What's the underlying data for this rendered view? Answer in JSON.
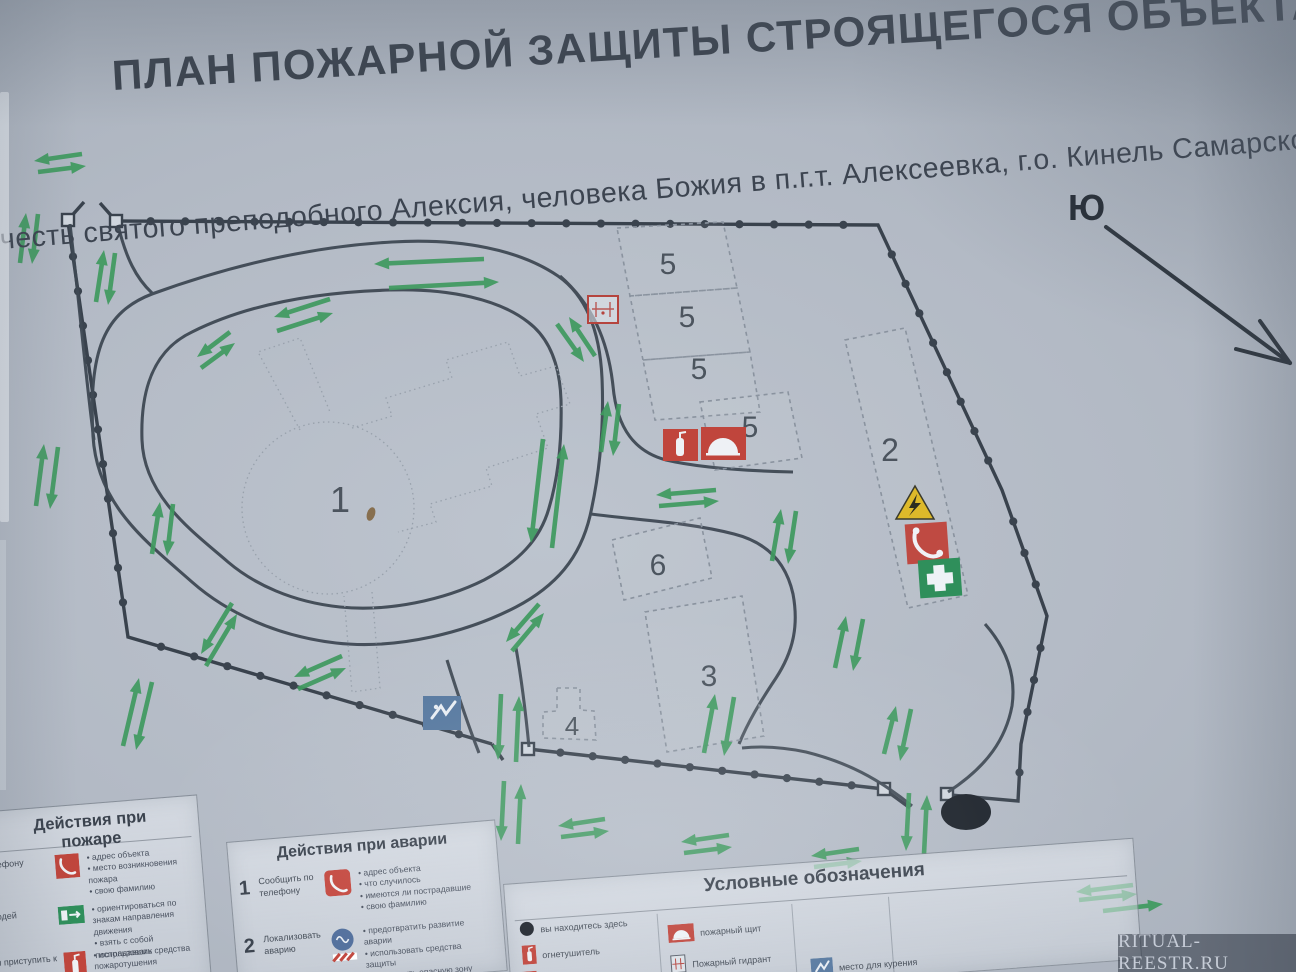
{
  "title": "ПЛАН ПОЖАРНОЙ ЗАЩИТЫ СТРОЯЩЕГОСЯ ОБЪЕКТА",
  "subtitle": "честь святого преподобного Алексия, человека Божия  в п.г.т. Алексеевка, г.о. Кинель Самарской о",
  "compass": {
    "label": "Ю"
  },
  "plan": {
    "buildings": [
      {
        "label": "1"
      },
      {
        "label": "2"
      },
      {
        "label": "3"
      },
      {
        "label": "4"
      },
      {
        "label": "5"
      },
      {
        "label": "5"
      },
      {
        "label": "5"
      },
      {
        "label": "5"
      },
      {
        "label": "6"
      }
    ],
    "icons": [
      "fire-hydrant",
      "fire-extinguisher",
      "fire-shield",
      "electrical-hazard",
      "emergency-phone",
      "first-aid",
      "smoking-area",
      "you-are-here"
    ]
  },
  "legend_fire": {
    "title": "Действия при пожаре",
    "rows": [
      {
        "label": "Сообщить по телефону",
        "bullets": [
          "адрес объекта",
          "место возникновения пожара",
          "свою фамилию"
        ]
      },
      {
        "label": "Эвакуировать людей",
        "bullets": [
          "ориентироваться по знакам направления движения",
          "взять с собой пострадавших"
        ]
      },
      {
        "label": "По возможности приступить к тушению",
        "bullets": [
          "использовать средства пожаротушения"
        ]
      }
    ]
  },
  "legend_accident": {
    "title": "Действия при аварии",
    "rows": [
      {
        "num": "1",
        "label": "Сообщить по телефону",
        "bullets": [
          "адрес объекта",
          "что случилось",
          "имеются ли пострадавшие",
          "свою фамилию"
        ]
      },
      {
        "num": "2",
        "label": "Локализовать аварию",
        "bullets": [
          "предотвратить развитие аварии",
          "использовать средства защиты",
          "обозначить опасную зону"
        ]
      }
    ]
  },
  "legend_symbols": {
    "title": "Условные обозначения",
    "items": [
      {
        "icon": "you-are-here-dot",
        "label": "вы находитесь здесь"
      },
      {
        "icon": "fire-extinguisher",
        "label": "огнетушитель"
      },
      {
        "icon": "fire-shield",
        "label": "пожарный щит"
      },
      {
        "icon": "fire-hydrant",
        "label": "Пожарный гидрант"
      },
      {
        "icon": "smoking-area",
        "label": "место для курения"
      }
    ]
  },
  "watermark": "RITUAL-REESTR.RU",
  "colors": {
    "arrow_green": "#3f9a5f",
    "line_dark": "#3a434e",
    "danger_red": "#c0453c",
    "safe_green": "#2f8f5b",
    "info_blue": "#56789f",
    "warning_yellow": "#ddb92a"
  }
}
